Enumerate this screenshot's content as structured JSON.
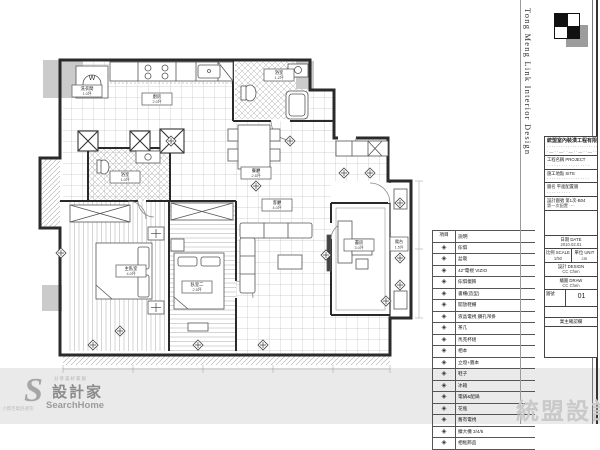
{
  "sidebar": {
    "vertical_title": "Tong Meng Link Interior Design"
  },
  "titleblock": {
    "company_name": "統盟室內裝潢工程有限公司",
    "company_line2": "···········································",
    "company_line3": "·—··—··—··—··—··—·",
    "project_label": "工程名稱 PROJECT",
    "project_value": "··················",
    "site_label": "施工地點 SITE",
    "site_value": "··················",
    "drawing_label": "圖名",
    "drawing_value": "平面配置圖",
    "sheetno_label": "設計圖號 第1次-B04",
    "sheetno_value": "第一次配置 ····",
    "date_label": "日期 DATE",
    "date_value": "2010.02.01",
    "scale_label": "比例 SCALE",
    "scale_value": "1/50",
    "unit_label": "單位 UNIT",
    "unit_value": "cm",
    "design_label": "設計 DESIGN",
    "design_value": "CC Chen",
    "draw_label": "繪圖 DRAW",
    "draw_value": "CC Chen",
    "no_label": "圖號",
    "no_value": "01",
    "confirm_label": "業主確認欄"
  },
  "legend": {
    "headers": [
      "項目",
      "說明"
    ],
    "rows": [
      {
        "label": "傢俱"
      },
      {
        "label": "盆栽"
      },
      {
        "label": "42\"電視 VIZIO"
      },
      {
        "label": "傢俱擺飾"
      },
      {
        "label": "書櫃(造型)"
      },
      {
        "label": "開放鞋櫃"
      },
      {
        "label": "液晶電視 鑽孔吊掛"
      },
      {
        "label": "茶几"
      },
      {
        "label": "馬克杯組"
      },
      {
        "label": "相本"
      },
      {
        "label": "立燈+圖本"
      },
      {
        "label": "鞋子"
      },
      {
        "label": "冰箱"
      },
      {
        "label": "電鍋&配鍋"
      },
      {
        "label": "花瓶"
      },
      {
        "label": "舊有電視"
      },
      {
        "label": "擴大機 3/4/5"
      },
      {
        "label": "相框飾品"
      }
    ]
  },
  "rooms": [
    {
      "name": "洗衣間",
      "area": "1.0坪"
    },
    {
      "name": "廚房",
      "area": "2.0坪"
    },
    {
      "name": "浴室",
      "area": "1.2坪"
    },
    {
      "name": "餐廳",
      "area": "2.5坪"
    },
    {
      "name": "客廳",
      "area": "4.0坪"
    },
    {
      "name": "書房",
      "area": "3.0坪"
    },
    {
      "name": "主臥室",
      "area": "4.0坪"
    },
    {
      "name": "臥室二",
      "area": "2.5坪"
    },
    {
      "name": "浴室",
      "area": "1.0坪"
    },
    {
      "name": "陽台",
      "area": "1.5坪"
    }
  ],
  "logo": {
    "caption_top": "分享美好家居",
    "s_glyph": "S",
    "name": "設計家",
    "sub": "SearchHome",
    "tiny_caption": "小資百萬舒適宅"
  },
  "watermark": "統盟設計",
  "icons": {
    "legend_marker": "◈",
    "washer": "W"
  },
  "colors": {
    "band": "#eaeaea",
    "wall": "#2a2a2a",
    "tile": "#c5c5c5",
    "watermark": "#c9c9c9"
  }
}
